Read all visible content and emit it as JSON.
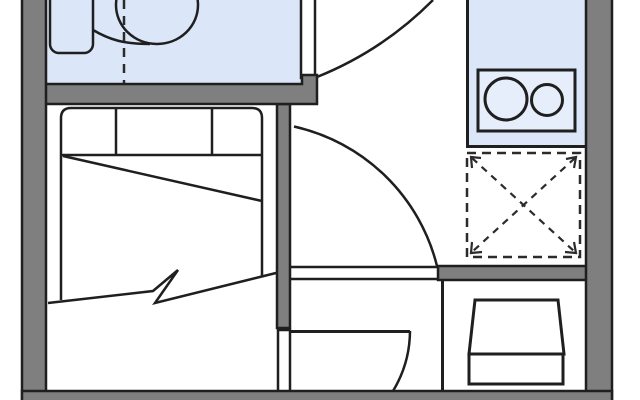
{
  "page": {
    "title": "apartment-floor-plan",
    "background": "#ffffff",
    "canvas": {
      "width": 640,
      "height": 400
    }
  },
  "colors": {
    "wall_fill": "#7f7f7f",
    "outline": "#1f1f1f",
    "room_fill_blue": "#dbe7f8",
    "cooktop_fill": "#e6eefb",
    "white": "#ffffff",
    "dash_line": "#2b2b2b"
  },
  "plan": {
    "elements": [
      {
        "tag": "rect",
        "name": "bathroom-floor",
        "attrs": {
          "x": 46,
          "y": 0,
          "width": 255,
          "height": 85,
          "fill": "#dbe7f8"
        }
      },
      {
        "tag": "rect",
        "name": "kitchen-floor",
        "attrs": {
          "x": 466,
          "y": 0,
          "width": 120,
          "height": 148,
          "fill": "#dbe7f8"
        }
      },
      {
        "tag": "path",
        "name": "kitchen-floor-edge",
        "attrs": {
          "d": "M467.5,0 L467.5,146.5 L586,146.5",
          "fill": "none",
          "stroke": "#1f1f1f",
          "stroke-width": 3
        }
      },
      {
        "tag": "rect",
        "name": "bathroom-sink",
        "attrs": {
          "x": 50,
          "y": -8,
          "width": 43,
          "height": 61,
          "rx": 9,
          "fill": "#dbe7f8",
          "stroke": "#1f1f1f",
          "stroke-width": 2.5
        }
      },
      {
        "tag": "path",
        "name": "toilet-connector",
        "attrs": {
          "d": "M93,30 C110,40 124,44 150,44",
          "fill": "none",
          "stroke": "#1f1f1f",
          "stroke-width": 2.5
        }
      },
      {
        "tag": "ellipse",
        "name": "toilet-bowl",
        "attrs": {
          "cx": 157,
          "cy": 5,
          "rx": 41,
          "ry": 39,
          "fill": "#dbe7f8",
          "stroke": "#1f1f1f",
          "stroke-width": 2.5
        }
      },
      {
        "tag": "line",
        "name": "shower-partition-dashed-line",
        "attrs": {
          "x1": 124,
          "y1": 0,
          "x2": 124,
          "y2": 84,
          "stroke": "#2b2b2b",
          "stroke-width": 2.5,
          "stroke-dasharray": "9 7"
        }
      },
      {
        "tag": "rect",
        "name": "cooktop-frame",
        "attrs": {
          "x": 478,
          "y": 70,
          "width": 97,
          "height": 61,
          "fill": "#e6eefb",
          "stroke": "#1f1f1f",
          "stroke-width": 3
        }
      },
      {
        "tag": "circle",
        "name": "cooktop-burner-large",
        "attrs": {
          "cx": 506,
          "cy": 99,
          "r": 21,
          "fill": "none",
          "stroke": "#1f1f1f",
          "stroke-width": 3
        }
      },
      {
        "tag": "circle",
        "name": "cooktop-burner-small",
        "attrs": {
          "cx": 547,
          "cy": 100,
          "r": 15.5,
          "fill": "none",
          "stroke": "#1f1f1f",
          "stroke-width": 3
        }
      },
      {
        "tag": "rect",
        "name": "appliance-space-dashed-box",
        "attrs": {
          "x": 467,
          "y": 153,
          "width": 113,
          "height": 104,
          "fill": "none",
          "stroke": "#2b2b2b",
          "stroke-width": 2.5,
          "stroke-dasharray": "9 6"
        }
      },
      {
        "tag": "line",
        "name": "appliance-space-diagonal-1",
        "attrs": {
          "x1": 472,
          "y1": 158,
          "x2": 575,
          "y2": 252,
          "stroke": "#2b2b2b",
          "stroke-width": 2.2,
          "stroke-dasharray": "7 6"
        }
      },
      {
        "tag": "line",
        "name": "appliance-space-diagonal-2",
        "attrs": {
          "x1": 575,
          "y1": 158,
          "x2": 472,
          "y2": 252,
          "stroke": "#2b2b2b",
          "stroke-width": 2.2,
          "stroke-dasharray": "7 6"
        }
      },
      {
        "tag": "path",
        "name": "appliance-arrow-top-left",
        "attrs": {
          "d": "M481,158 L471,157 L472,168",
          "fill": "none",
          "stroke": "#2b2b2b",
          "stroke-width": 2.2
        }
      },
      {
        "tag": "path",
        "name": "appliance-arrow-top-right",
        "attrs": {
          "d": "M566,159 L576,157 L574,168",
          "fill": "none",
          "stroke": "#2b2b2b",
          "stroke-width": 2.2
        }
      },
      {
        "tag": "path",
        "name": "appliance-arrow-bottom-left",
        "attrs": {
          "d": "M472,242 L471,253 L482,252",
          "fill": "none",
          "stroke": "#2b2b2b",
          "stroke-width": 2.2
        }
      },
      {
        "tag": "path",
        "name": "appliance-arrow-bottom-right",
        "attrs": {
          "d": "M574,242 L576,253 L565,252",
          "fill": "none",
          "stroke": "#2b2b2b",
          "stroke-width": 2.2
        }
      },
      {
        "tag": "path",
        "name": "bed-outline",
        "attrs": {
          "d": "M61,300 L61,118 Q61,108 71,108 L252,108 Q262,108 262,118 L262,277",
          "fill": "none",
          "stroke": "#1f1f1f",
          "stroke-width": 2.5
        }
      },
      {
        "tag": "line",
        "name": "bed-pillow-line",
        "attrs": {
          "x1": 61,
          "y1": 155,
          "x2": 262,
          "y2": 155,
          "stroke": "#1f1f1f",
          "stroke-width": 2.5
        }
      },
      {
        "tag": "line",
        "name": "bed-pillow-divider-1",
        "attrs": {
          "x1": 116,
          "y1": 108,
          "x2": 116,
          "y2": 155,
          "stroke": "#1f1f1f",
          "stroke-width": 2.5
        }
      },
      {
        "tag": "line",
        "name": "bed-pillow-divider-2",
        "attrs": {
          "x1": 212,
          "y1": 108,
          "x2": 212,
          "y2": 155,
          "stroke": "#1f1f1f",
          "stroke-width": 2.5
        }
      },
      {
        "tag": "line",
        "name": "bed-blanket-fold-line",
        "attrs": {
          "x1": 63,
          "y1": 156,
          "x2": 262,
          "y2": 201,
          "stroke": "#1f1f1f",
          "stroke-width": 2.5
        }
      },
      {
        "tag": "polyline",
        "name": "bed-break-line",
        "attrs": {
          "points": "48,303 153,291 178,270 155,303 280,272",
          "fill": "none",
          "stroke": "#1f1f1f",
          "stroke-width": 2.5
        }
      },
      {
        "tag": "rect",
        "name": "wall-mid-vertical",
        "attrs": {
          "x": 277,
          "y": 104,
          "width": 13,
          "height": 224,
          "fill": "#7f7f7f",
          "stroke": "#1f1f1f",
          "stroke-width": 2.5
        }
      },
      {
        "tag": "rect",
        "name": "partition-bathroom-right",
        "attrs": {
          "x": 301,
          "y": -4,
          "width": 14,
          "height": 82,
          "fill": "#ffffff",
          "stroke": "#1f1f1f",
          "stroke-width": 2.5
        }
      },
      {
        "tag": "polygon",
        "name": "wall-bathroom-bottom",
        "attrs": {
          "points": "44,84 302,84 302,75 317,75 317,104 44,104",
          "fill": "#7f7f7f",
          "stroke": "#1f1f1f",
          "stroke-width": 2.5
        }
      },
      {
        "tag": "rect",
        "name": "wall-mid-horizontal",
        "attrs": {
          "x": 438,
          "y": 266,
          "width": 150,
          "height": 14,
          "fill": "#7f7f7f",
          "stroke": "#1f1f1f",
          "stroke-width": 2.5
        }
      },
      {
        "tag": "rect",
        "name": "partition-closet-left",
        "attrs": {
          "x": 278,
          "y": 330,
          "width": 12,
          "height": 62,
          "fill": "#ffffff",
          "stroke": "#1f1f1f",
          "stroke-width": 2.5
        }
      },
      {
        "tag": "rect",
        "name": "wall-left",
        "attrs": {
          "x": 22,
          "y": -6,
          "width": 24,
          "height": 412,
          "fill": "#7f7f7f",
          "stroke": "#1f1f1f",
          "stroke-width": 2.5
        }
      },
      {
        "tag": "rect",
        "name": "wall-right",
        "attrs": {
          "x": 586,
          "y": -6,
          "width": 26,
          "height": 412,
          "fill": "#7f7f7f",
          "stroke": "#1f1f1f",
          "stroke-width": 2.5
        }
      },
      {
        "tag": "rect",
        "name": "wall-bottom",
        "attrs": {
          "x": 22,
          "y": 391,
          "width": 590,
          "height": 14,
          "fill": "#7f7f7f",
          "stroke": "#1f1f1f",
          "stroke-width": 2.5
        }
      },
      {
        "tag": "line",
        "name": "partition-storage-divider",
        "attrs": {
          "x1": 442.5,
          "y1": 280,
          "x2": 442.5,
          "y2": 392,
          "stroke": "#1f1f1f",
          "stroke-width": 3
        }
      },
      {
        "tag": "line",
        "name": "hall-opening-top-line",
        "attrs": {
          "x1": 290,
          "y1": 267,
          "x2": 438,
          "y2": 267,
          "stroke": "#1f1f1f",
          "stroke-width": 2.5
        }
      },
      {
        "tag": "line",
        "name": "hall-opening-bottom-line",
        "attrs": {
          "x1": 290,
          "y1": 279,
          "x2": 438,
          "y2": 279,
          "stroke": "#1f1f1f",
          "stroke-width": 2.5
        }
      },
      {
        "tag": "path",
        "name": "door-swing-arc-entrance",
        "attrs": {
          "d": "M433,0 A345,345 0 0 1 317,77",
          "fill": "none",
          "stroke": "#1f1f1f",
          "stroke-width": 2.5
        }
      },
      {
        "tag": "path",
        "name": "door-swing-arc-hall",
        "attrs": {
          "d": "M294,126.5 A190,190 0 0 1 437,266",
          "fill": "none",
          "stroke": "#1f1f1f",
          "stroke-width": 2.5
        }
      },
      {
        "tag": "line",
        "name": "door-leaf-closet",
        "attrs": {
          "x1": 290,
          "y1": 331.5,
          "x2": 410,
          "y2": 331.5,
          "stroke": "#1f1f1f",
          "stroke-width": 3
        }
      },
      {
        "tag": "path",
        "name": "door-swing-arc-closet",
        "attrs": {
          "d": "M410,331 A117,117 0 0 1 393,391",
          "fill": "none",
          "stroke": "#1f1f1f",
          "stroke-width": 2.5
        }
      },
      {
        "tag": "polygon",
        "name": "armchair-backrest",
        "attrs": {
          "points": "475,300 558,300 564,354 469,354",
          "fill": "#ffffff",
          "stroke": "#1f1f1f",
          "stroke-width": 3
        }
      },
      {
        "tag": "rect",
        "name": "armchair-seat",
        "attrs": {
          "x": 469,
          "y": 354,
          "width": 94,
          "height": 30,
          "fill": "#ffffff",
          "stroke": "#1f1f1f",
          "stroke-width": 3
        }
      }
    ]
  }
}
